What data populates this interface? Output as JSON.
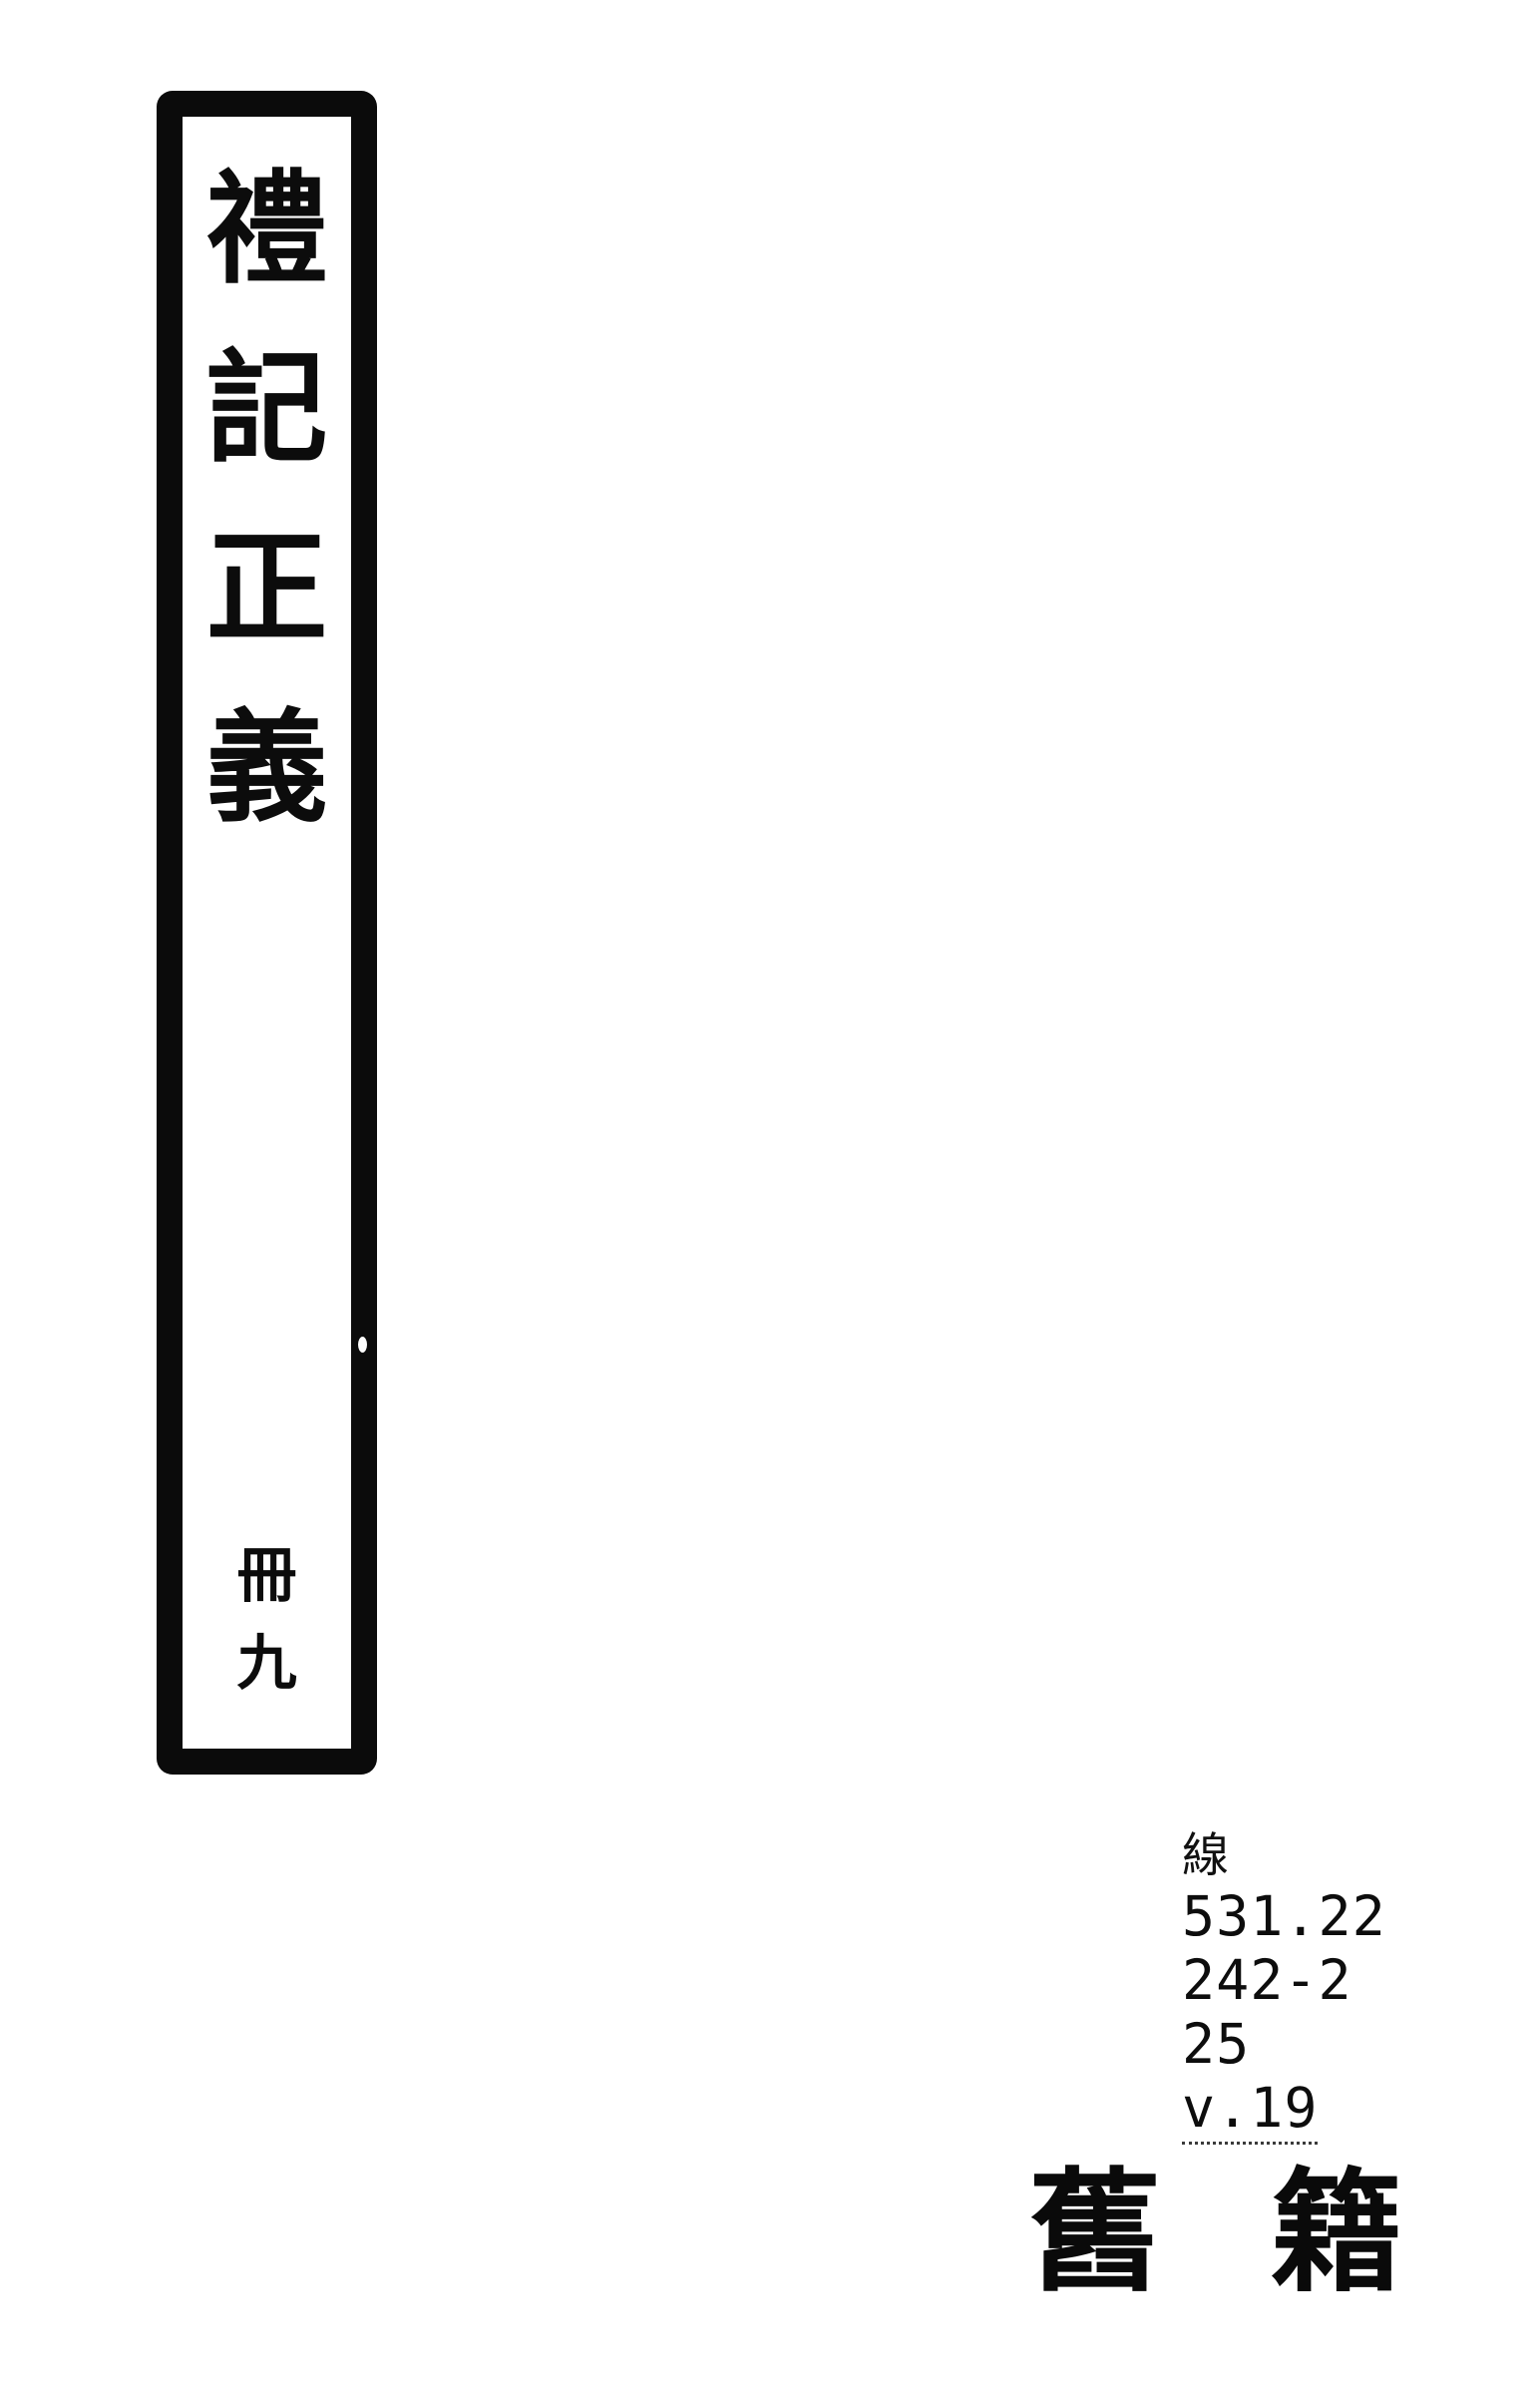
{
  "colors": {
    "ink": "#0a0a0a",
    "paper": "#ffffff"
  },
  "spine_label": {
    "title": "禮記正義",
    "title_chars": [
      "禮",
      "記",
      "正",
      "義"
    ],
    "volume": "冊九",
    "volume_chars": [
      "冊",
      "九"
    ]
  },
  "call_number": {
    "prefix": "線",
    "lines": [
      "531.22",
      "242-2",
      "25",
      "v.19"
    ]
  },
  "stamp": {
    "text": "舊籍",
    "chars": [
      "舊",
      "籍"
    ]
  }
}
